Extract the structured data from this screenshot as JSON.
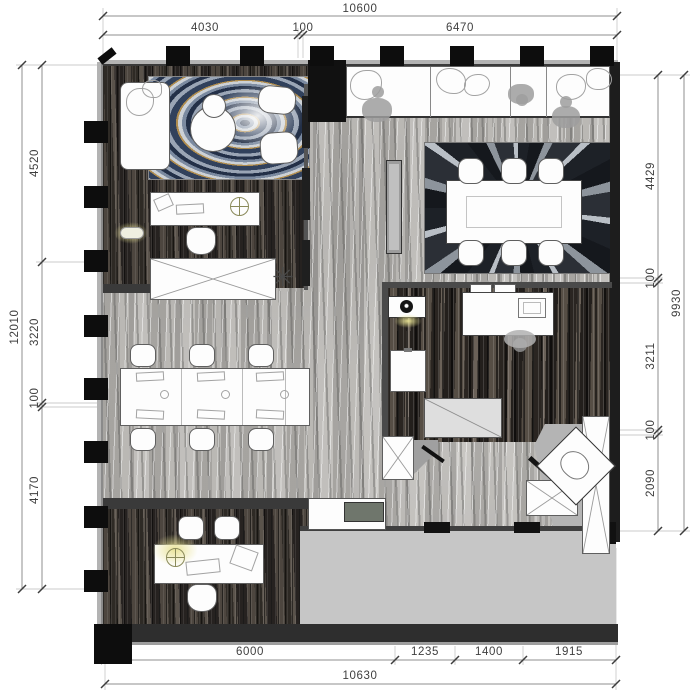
{
  "drawing": {
    "type": "office floor plan",
    "units": "mm"
  },
  "dims": {
    "top": {
      "overall": "10600",
      "seg": [
        "4030",
        "100",
        "6470"
      ]
    },
    "left": {
      "overall": "12010",
      "seg": [
        "4520",
        "3220",
        "100",
        "4170"
      ]
    },
    "right": {
      "overall": "9930",
      "seg": [
        "4429",
        "100",
        "3211",
        "100",
        "2090"
      ]
    },
    "bottom": {
      "overall": "10630",
      "seg": [
        "6000",
        "1235",
        "1400",
        "1915"
      ]
    }
  },
  "icons": {
    "plant_star": "✳"
  },
  "colors": {
    "wall_dark": "#1d1d1d",
    "column": "#0d0d0d",
    "marble": "#b5b3b0",
    "wood_dark": "#39332d",
    "corridor_gray": "#c6c6c6",
    "glow_yellow": "#e9e394",
    "rug_navy": "#233048",
    "rug_gold": "#b08d4f"
  }
}
